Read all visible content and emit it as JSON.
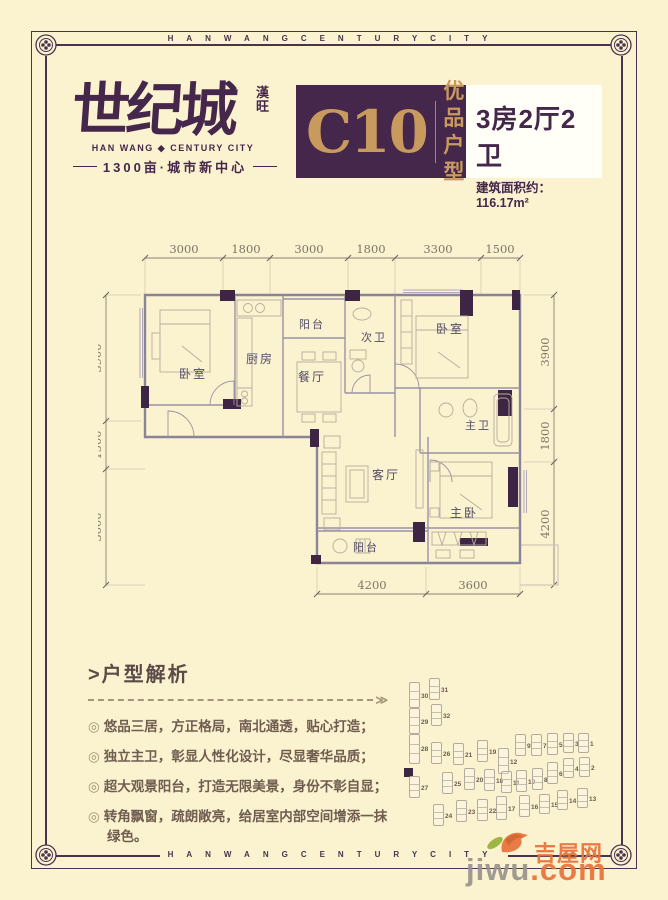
{
  "frame": {
    "top_text": "HANWANGCENTURYCITY",
    "bottom_text": "HANWANGCENTURYCITY"
  },
  "header": {
    "logo_main": "世纪城",
    "logo_seal_top": "漢",
    "logo_seal_bottom": "旺",
    "logo_sub_en": "HAN WANG ◆ CENTURY CITY",
    "logo_tagline": "1300亩·城市新中心",
    "unit_code": "C10",
    "unit_tag_line1": "优品",
    "unit_tag_line2": "户型",
    "spec_title": "3房2厅2卫",
    "spec_area": "建筑面积约：116.17m²"
  },
  "floorplan": {
    "dims_top": [
      "3000",
      "1800",
      "3000",
      "1800",
      "3300",
      "1500"
    ],
    "dims_left": [
      "3900",
      "1500",
      "3600"
    ],
    "dims_right": [
      "3900",
      "1800",
      "4200"
    ],
    "dims_bottom": [
      "4200",
      "3600"
    ],
    "rooms": {
      "bedroom_left": "卧室",
      "kitchen": "厨房",
      "balcony_top": "阳台",
      "bath_second": "次卫",
      "dining": "餐厅",
      "bedroom_right": "卧室",
      "bath_master": "主卫",
      "living": "客厅",
      "bedroom_master": "主卧",
      "balcony_bottom": "阳台"
    }
  },
  "analysis": {
    "heading": ">户型解析",
    "arrow": "≫",
    "bullet_marker": "◎",
    "bullets": [
      "悠品三居，方正格局，南北通透，贴心打造；",
      "独立主卫，彰显人性化设计，尽显奢华品质；",
      "超大观景阳台，打造无限美景，身份不彰自显；",
      "转角飘窗，疏朗敞亮，给居室内部空间增添一抹绿色。"
    ]
  },
  "sitemap": {
    "buildings": [
      {
        "n": "30",
        "x": 14,
        "y": 22,
        "h": 24
      },
      {
        "n": "31",
        "x": 34,
        "y": 18,
        "h": 20
      },
      {
        "n": "29",
        "x": 14,
        "y": 48,
        "h": 24
      },
      {
        "n": "32",
        "x": 36,
        "y": 44,
        "h": 20
      },
      {
        "n": "28",
        "x": 14,
        "y": 74,
        "h": 28
      },
      {
        "n": "26",
        "x": 36,
        "y": 82,
        "h": 20
      },
      {
        "n": "21",
        "x": 58,
        "y": 83,
        "h": 20
      },
      {
        "n": "19",
        "x": 82,
        "y": 80,
        "h": 20
      },
      {
        "n": "12",
        "x": 103,
        "y": 88,
        "h": 24
      },
      {
        "n": "9",
        "x": 120,
        "y": 74,
        "h": 20
      },
      {
        "n": "7",
        "x": 136,
        "y": 74,
        "h": 20
      },
      {
        "n": "5",
        "x": 152,
        "y": 73,
        "h": 20
      },
      {
        "n": "3",
        "x": 168,
        "y": 73,
        "h": 18
      },
      {
        "n": "1",
        "x": 183,
        "y": 73,
        "h": 18
      },
      {
        "n": "27",
        "x": 14,
        "y": 116,
        "h": 20
      },
      {
        "n": "25",
        "x": 47,
        "y": 112,
        "h": 20
      },
      {
        "n": "20",
        "x": 69,
        "y": 108,
        "h": 20
      },
      {
        "n": "18",
        "x": 89,
        "y": 109,
        "h": 20
      },
      {
        "n": "11",
        "x": 106,
        "y": 111,
        "h": 20
      },
      {
        "n": "10",
        "x": 121,
        "y": 110,
        "h": 20
      },
      {
        "n": "8",
        "x": 137,
        "y": 108,
        "h": 20
      },
      {
        "n": "6",
        "x": 152,
        "y": 102,
        "h": 20
      },
      {
        "n": "4",
        "x": 168,
        "y": 98,
        "h": 18
      },
      {
        "n": "2",
        "x": 184,
        "y": 97,
        "h": 18
      },
      {
        "n": "24",
        "x": 38,
        "y": 144,
        "h": 20
      },
      {
        "n": "23",
        "x": 61,
        "y": 140,
        "h": 20
      },
      {
        "n": "22",
        "x": 82,
        "y": 139,
        "h": 20
      },
      {
        "n": "17",
        "x": 101,
        "y": 136,
        "h": 22
      },
      {
        "n": "16",
        "x": 124,
        "y": 135,
        "h": 20
      },
      {
        "n": "15",
        "x": 144,
        "y": 134,
        "h": 18
      },
      {
        "n": "14",
        "x": 162,
        "y": 130,
        "h": 18
      },
      {
        "n": "13",
        "x": 182,
        "y": 128,
        "h": 18
      }
    ]
  },
  "watermark": {
    "site_cn": "吉屋网",
    "site_name": "jiwu",
    "site_tld": ".com"
  },
  "colors": {
    "cream_bg": "#fbf2cf",
    "brand_purple": "#45274b",
    "gold": "#c99a5e",
    "frame_line": "#4a3350",
    "wall_gray": "#8b8398",
    "column_fill": "#3f2544",
    "dim_text": "#7d7668",
    "body_text": "#6f5d4f",
    "watermark_orange": "#e8743c",
    "watermark_gray": "#9a948c",
    "leaf_green": "#9ab23a"
  }
}
